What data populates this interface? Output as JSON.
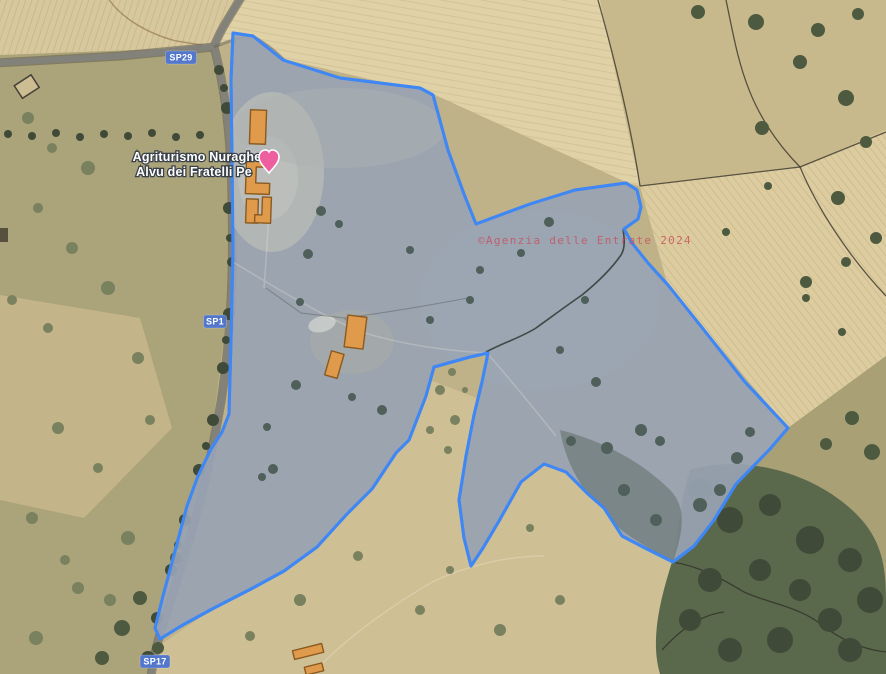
{
  "map": {
    "attribution_watermark": "©Agenzia delle Entrate 2024",
    "place_label": {
      "line1": "Agriturismo Nuraghe",
      "line2": "Alvu dei Fratelli Pe"
    },
    "road_badges": [
      {
        "label": "SP29"
      },
      {
        "label": "SP1"
      },
      {
        "label": "SP17"
      }
    ],
    "poi_marker": "lodging-heart-marker"
  },
  "parcel": {
    "outline_points": [
      [
        233,
        33
      ],
      [
        253,
        36
      ],
      [
        283,
        60
      ],
      [
        340,
        78
      ],
      [
        420,
        88
      ],
      [
        433,
        95
      ],
      [
        448,
        150
      ],
      [
        464,
        194
      ],
      [
        476,
        224
      ],
      [
        530,
        204
      ],
      [
        575,
        190
      ],
      [
        626,
        183
      ],
      [
        637,
        190
      ],
      [
        641,
        207
      ],
      [
        638,
        219
      ],
      [
        624,
        229
      ],
      [
        632,
        243
      ],
      [
        648,
        263
      ],
      [
        668,
        285
      ],
      [
        700,
        325
      ],
      [
        745,
        382
      ],
      [
        788,
        428
      ],
      [
        770,
        449
      ],
      [
        736,
        484
      ],
      [
        714,
        520
      ],
      [
        694,
        546
      ],
      [
        673,
        562
      ],
      [
        645,
        548
      ],
      [
        622,
        536
      ],
      [
        604,
        508
      ],
      [
        588,
        494
      ],
      [
        566,
        472
      ],
      [
        544,
        464
      ],
      [
        521,
        482
      ],
      [
        499,
        521
      ],
      [
        483,
        548
      ],
      [
        471,
        566
      ],
      [
        464,
        538
      ],
      [
        459,
        500
      ],
      [
        466,
        456
      ],
      [
        474,
        415
      ],
      [
        482,
        382
      ],
      [
        488,
        353
      ],
      [
        470,
        357
      ],
      [
        434,
        367
      ],
      [
        426,
        396
      ],
      [
        409,
        440
      ],
      [
        396,
        453
      ],
      [
        372,
        489
      ],
      [
        347,
        514
      ],
      [
        317,
        547
      ],
      [
        284,
        571
      ],
      [
        251,
        589
      ],
      [
        214,
        608
      ],
      [
        181,
        626
      ],
      [
        160,
        639
      ],
      [
        155,
        628
      ],
      [
        163,
        596
      ],
      [
        171,
        566
      ],
      [
        179,
        536
      ],
      [
        187,
        506
      ],
      [
        198,
        476
      ],
      [
        211,
        449
      ],
      [
        222,
        432
      ],
      [
        229,
        414
      ],
      [
        231,
        340
      ],
      [
        233,
        250
      ],
      [
        232,
        150
      ],
      [
        231,
        80
      ]
    ]
  },
  "theme": {
    "parcel_stroke": "#3f87f5",
    "parcel_fill": "#98a3b2",
    "building_fill": "#df9a4b",
    "building_stroke": "#8a5a1f",
    "badge_bg": "#5377cb",
    "badge_text": "#ffffff",
    "label_text": "#ffffff",
    "label_halo": "#3a4148",
    "watermark": "#c84f5c",
    "marker_pink": "#ee5fa0"
  }
}
